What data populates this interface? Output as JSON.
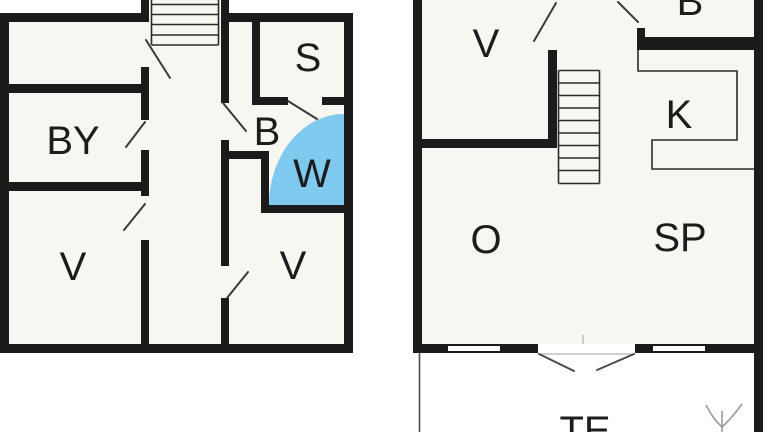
{
  "plans": {
    "left": {
      "rooms": [
        {
          "label": "BY"
        },
        {
          "label": "S"
        },
        {
          "label": "B"
        },
        {
          "label": "W"
        },
        {
          "label": "V"
        },
        {
          "label": "V"
        }
      ]
    },
    "right": {
      "rooms": [
        {
          "label": "V"
        },
        {
          "label": "B"
        },
        {
          "label": "K"
        },
        {
          "label": "O"
        },
        {
          "label": "SP"
        },
        {
          "label": "TE"
        }
      ]
    }
  },
  "colors": {
    "wall": "#1b1b1b",
    "room_fill": "#f8f6f1",
    "wet_room_highlight": "#7ec9ed",
    "background": "#ffffff"
  }
}
